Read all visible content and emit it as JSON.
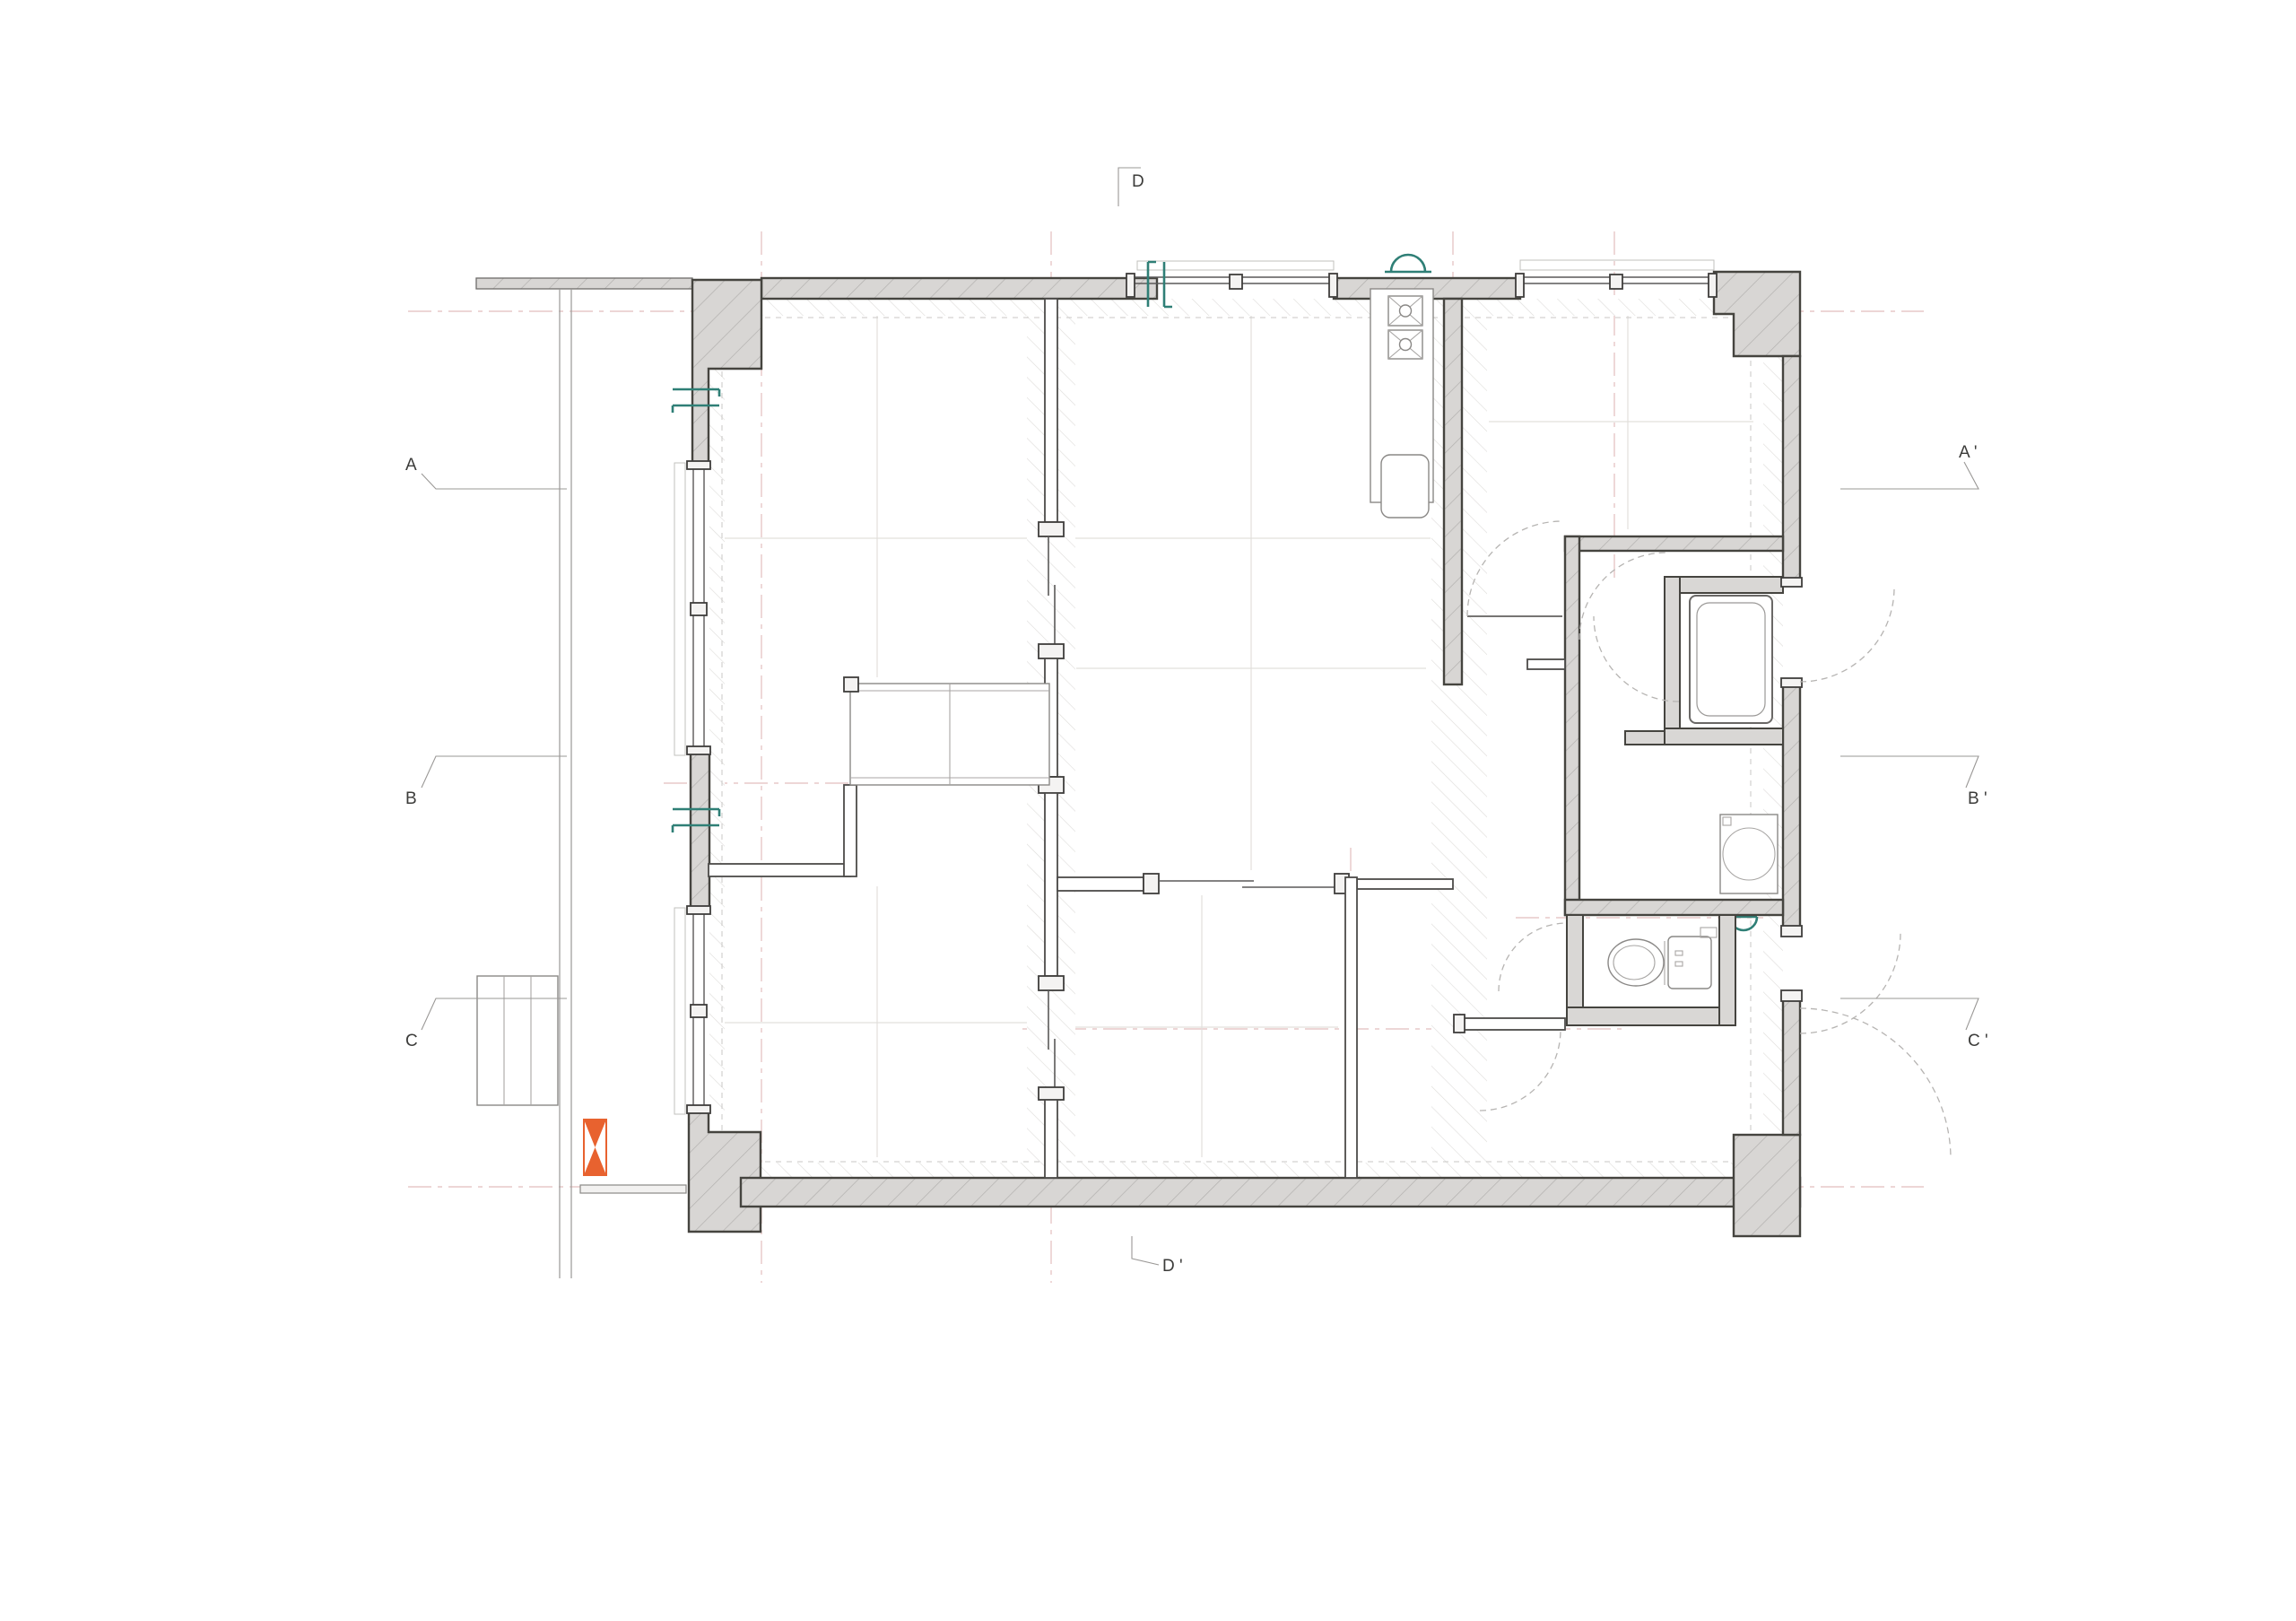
{
  "page": {
    "type": "architectural floor plan - apartment unit",
    "background": "#ffffff"
  },
  "colors": {
    "wall_fill": "#d8d6d4",
    "wall_outline": "#45443f",
    "accent_teal": "#2f7f76",
    "accent_orange": "#e8622f",
    "grid_red": "#dcaeae",
    "door_arc": "#b6b4b2"
  },
  "section_markers": {
    "d_top": "D",
    "d_bottom": "D '",
    "a_left": "A",
    "a_right": "A '",
    "b_left": "B",
    "b_right": "B '",
    "c_left": "C",
    "c_right": "C '"
  },
  "fixtures": {
    "kitchen_stove": "two-burner stove",
    "kitchen_sink": "kitchen sink",
    "range_hood": "range hood",
    "bathtub": "bathtub",
    "washing_machine": "washing machine",
    "toilet": "toilet",
    "utility_sink": "wall-hung basin",
    "closet": "closet",
    "balcony_steps": "balcony steps",
    "entry_marker": "orange entry marker"
  }
}
